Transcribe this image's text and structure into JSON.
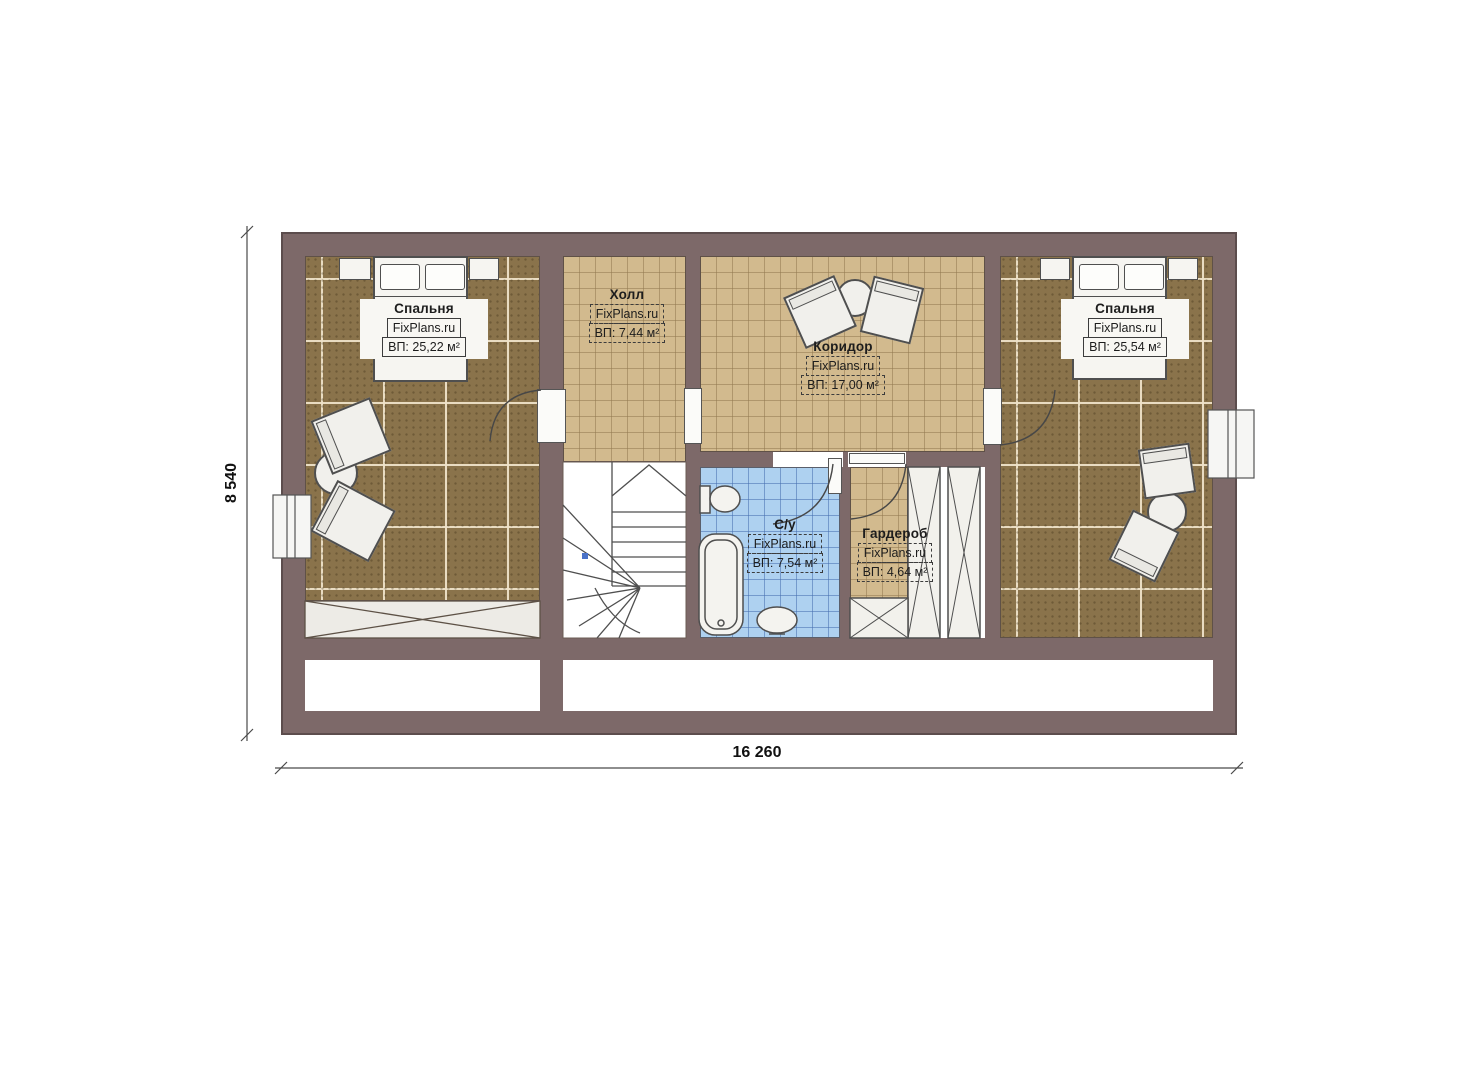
{
  "plan": {
    "brand_watermark": "FixPlans.ru",
    "dimensions": {
      "height": "8 540",
      "width": "16 260"
    },
    "rooms": [
      {
        "key": "bedroom-left",
        "name": "Спальня",
        "brand": "FixPlans.ru",
        "area": "ВП: 25,22 м²"
      },
      {
        "key": "hall",
        "name": "Холл",
        "brand": "FixPlans.ru",
        "area": "ВП: 7,44 м²"
      },
      {
        "key": "corridor",
        "name": "Коридор",
        "brand": "FixPlans.ru",
        "area": "ВП: 17,00 м²"
      },
      {
        "key": "bathroom",
        "name": "С/у",
        "brand": "FixPlans.ru",
        "area": "ВП: 7,54 м²"
      },
      {
        "key": "wardrobe",
        "name": "Гардероб",
        "brand": "FixPlans.ru",
        "area": "ВП: 4,64 м²"
      },
      {
        "key": "bedroom-right",
        "name": "Спальня",
        "brand": "FixPlans.ru",
        "area": "ВП: 25,54 м²"
      }
    ],
    "colors": {
      "wall": "#7d6969",
      "carpet_floor": "#8a734b",
      "tile_tan": "#d2ba8e",
      "tile_blue": "#aed1f0"
    }
  }
}
